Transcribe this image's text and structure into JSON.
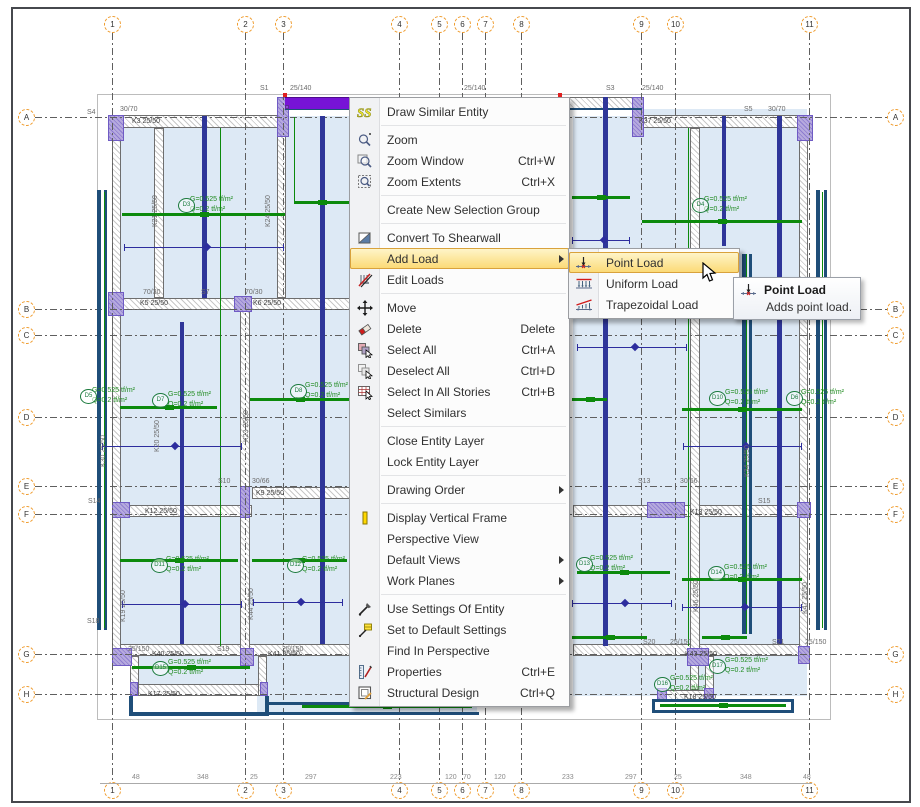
{
  "window": {
    "bg": "#ffffff",
    "accent_highlight": "#fbd973",
    "selection_color": "#7713d6"
  },
  "context_menu": {
    "x": 349,
    "y": 97,
    "w": 221,
    "items": [
      {
        "label": "Draw Similar Entity",
        "icon": "draw-similar-icon",
        "sep_after": true
      },
      {
        "label": "Zoom",
        "icon": "zoom-icon"
      },
      {
        "label": "Zoom Window",
        "icon": "zoom-window-icon",
        "shortcut": "Ctrl+W"
      },
      {
        "label": "Zoom Extents",
        "icon": "zoom-extents-icon",
        "shortcut": "Ctrl+X",
        "sep_after": true
      },
      {
        "label": "Create New Selection Group",
        "sep_after": true
      },
      {
        "label": "Convert To Shearwall",
        "icon": "shearwall-icon"
      },
      {
        "label": "Add Load",
        "submenu": true,
        "highlighted": true
      },
      {
        "label": "Edit Loads",
        "icon": "edit-loads-icon",
        "sep_after": true
      },
      {
        "label": "Move",
        "icon": "move-icon"
      },
      {
        "label": "Delete",
        "icon": "delete-icon",
        "shortcut": "Delete"
      },
      {
        "label": "Select All",
        "icon": "select-all-icon",
        "shortcut": "Ctrl+A"
      },
      {
        "label": "Deselect All",
        "icon": "deselect-all-icon",
        "shortcut": "Ctrl+D"
      },
      {
        "label": "Select In All Stories",
        "icon": "select-stories-icon",
        "shortcut": "Ctrl+B"
      },
      {
        "label": "Select Similars",
        "sep_after": true
      },
      {
        "label": "Close Entity Layer"
      },
      {
        "label": "Lock Entity Layer",
        "sep_after": true
      },
      {
        "label": "Drawing Order",
        "submenu": true,
        "sep_after": true
      },
      {
        "label": "Display Vertical Frame",
        "icon": "column-icon"
      },
      {
        "label": "Perspective View"
      },
      {
        "label": "Default Views",
        "submenu": true
      },
      {
        "label": "Work Planes",
        "submenu": true,
        "sep_after": true
      },
      {
        "label": "Use Settings Of Entity",
        "icon": "pipette-icon"
      },
      {
        "label": "Set to Default Settings",
        "icon": "pipette-default-icon"
      },
      {
        "label": "Find In Perspective"
      },
      {
        "label": "Properties",
        "icon": "properties-icon",
        "shortcut": "Ctrl+E"
      },
      {
        "label": "Structural Design",
        "icon": "structural-design-icon",
        "shortcut": "Ctrl+Q"
      }
    ]
  },
  "submenu": {
    "x": 568,
    "y": 248,
    "w": 172,
    "items": [
      {
        "label": "Point Load",
        "icon": "point-load-icon",
        "highlighted": true
      },
      {
        "label": "Uniform Load",
        "icon": "uniform-load-icon"
      },
      {
        "label": "Trapezoidal Load",
        "icon": "trapezoidal-load-icon"
      }
    ]
  },
  "tooltip": {
    "x": 733,
    "y": 277,
    "title": "Point Load",
    "body": "Adds point load.",
    "icon": "point-load-icon"
  },
  "plan": {
    "frame": [
      95,
      92,
      732,
      624
    ],
    "grid_numbers": [
      {
        "n": "1",
        "x": 110
      },
      {
        "n": "2",
        "x": 243
      },
      {
        "n": "3",
        "x": 281
      },
      {
        "n": "4",
        "x": 397
      },
      {
        "n": "5",
        "x": 437
      },
      {
        "n": "6",
        "x": 460
      },
      {
        "n": "7",
        "x": 483
      },
      {
        "n": "8",
        "x": 519
      },
      {
        "n": "9",
        "x": 639
      },
      {
        "n": "10",
        "x": 673
      },
      {
        "n": "11",
        "x": 807
      }
    ],
    "grid_letters": [
      {
        "n": "A",
        "y": 115
      },
      {
        "n": "B",
        "y": 307
      },
      {
        "n": "C",
        "y": 333
      },
      {
        "n": "D",
        "y": 415
      },
      {
        "n": "E",
        "y": 484
      },
      {
        "n": "F",
        "y": 512
      },
      {
        "n": "G",
        "y": 652
      },
      {
        "n": "H",
        "y": 692
      }
    ],
    "bottom_dims": [
      {
        "t": "48",
        "x": 130
      },
      {
        "t": "348",
        "x": 195
      },
      {
        "t": "25",
        "x": 248
      },
      {
        "t": "297",
        "x": 303
      },
      {
        "t": "223",
        "x": 388
      },
      {
        "t": "120",
        "x": 443
      },
      {
        "t": "70",
        "x": 461
      },
      {
        "t": "120",
        "x": 492
      },
      {
        "t": "233",
        "x": 560
      },
      {
        "t": "297",
        "x": 623
      },
      {
        "t": "25",
        "x": 672
      },
      {
        "t": "348",
        "x": 738
      },
      {
        "t": "48",
        "x": 801
      }
    ],
    "slabs": [
      [
        115,
        114,
        234,
        531
      ],
      [
        571,
        114,
        234,
        531
      ],
      [
        128,
        654,
        221,
        40
      ],
      [
        571,
        654,
        234,
        40
      ],
      [
        255,
        654,
        220,
        56
      ],
      [
        640,
        107,
        165,
        7
      ]
    ],
    "hatch_h": [
      [
        283,
        95,
        357,
        12
      ],
      [
        115,
        113,
        168,
        13
      ],
      [
        640,
        113,
        165,
        13
      ],
      [
        115,
        296,
        234,
        12
      ],
      [
        571,
        299,
        234,
        12
      ],
      [
        115,
        503,
        135,
        12
      ],
      [
        250,
        485,
        99,
        12
      ],
      [
        571,
        503,
        234,
        12
      ],
      [
        115,
        642,
        234,
        12
      ],
      [
        571,
        642,
        234,
        12
      ],
      [
        128,
        682,
        137,
        12
      ],
      [
        655,
        688,
        57,
        12
      ]
    ],
    "hatch_v": [
      [
        110,
        114,
        9,
        540
      ],
      [
        797,
        114,
        9,
        540
      ],
      [
        152,
        126,
        10,
        170
      ],
      [
        275,
        126,
        9,
        170
      ],
      [
        238,
        296,
        10,
        358
      ],
      [
        688,
        126,
        10,
        528
      ],
      [
        128,
        654,
        9,
        40
      ],
      [
        256,
        654,
        9,
        40
      ],
      [
        688,
        654,
        9,
        34
      ],
      [
        703,
        654,
        9,
        34
      ]
    ],
    "columns": [
      [
        106,
        113,
        16,
        26
      ],
      [
        275,
        95,
        12,
        40
      ],
      [
        630,
        95,
        12,
        40
      ],
      [
        795,
        113,
        16,
        26
      ],
      [
        106,
        290,
        16,
        24
      ],
      [
        232,
        294,
        18,
        16
      ],
      [
        795,
        290,
        16,
        20
      ],
      [
        713,
        295,
        16,
        16
      ],
      [
        110,
        500,
        18,
        16
      ],
      [
        238,
        484,
        10,
        32
      ],
      [
        645,
        500,
        38,
        16
      ],
      [
        795,
        500,
        14,
        16
      ],
      [
        110,
        646,
        20,
        18
      ],
      [
        238,
        646,
        14,
        18
      ],
      [
        685,
        646,
        22,
        18
      ],
      [
        796,
        644,
        12,
        18
      ],
      [
        128,
        680,
        8,
        14
      ],
      [
        258,
        680,
        8,
        14
      ],
      [
        655,
        686,
        10,
        14
      ],
      [
        702,
        686,
        10,
        14
      ]
    ],
    "navy_walls": [
      [
        95,
        188,
        4,
        440
      ],
      [
        102,
        188,
        3,
        440
      ],
      [
        814,
        188,
        4,
        440
      ],
      [
        822,
        188,
        3,
        440
      ],
      [
        740,
        252,
        4,
        380
      ],
      [
        747,
        252,
        3,
        380
      ],
      [
        127,
        694,
        4,
        20
      ],
      [
        263,
        694,
        4,
        20
      ],
      [
        127,
        710,
        140,
        4
      ],
      [
        265,
        700,
        212,
        3
      ],
      [
        265,
        710,
        212,
        3
      ],
      [
        650,
        697,
        3,
        14
      ],
      [
        789,
        697,
        3,
        14
      ],
      [
        650,
        697,
        142,
        3
      ],
      [
        650,
        708,
        142,
        3
      ],
      [
        283,
        106,
        357,
        2
      ]
    ],
    "navy_beams_v": [
      [
        200,
        114,
        5,
        182
      ],
      [
        178,
        320,
        4,
        322
      ],
      [
        318,
        114,
        5,
        528
      ],
      [
        601,
        95,
        5,
        549
      ],
      [
        720,
        114,
        4,
        130
      ],
      [
        775,
        114,
        5,
        528
      ]
    ],
    "green_h": [
      [
        120,
        211,
        163
      ],
      [
        292,
        199,
        55
      ],
      [
        570,
        194,
        58
      ],
      [
        640,
        218,
        160
      ],
      [
        118,
        404,
        97
      ],
      [
        248,
        396,
        99
      ],
      [
        570,
        396,
        35
      ],
      [
        680,
        406,
        120
      ],
      [
        118,
        557,
        118
      ],
      [
        250,
        557,
        95
      ],
      [
        575,
        569,
        93
      ],
      [
        680,
        576,
        120
      ],
      [
        130,
        664,
        118
      ],
      [
        570,
        634,
        75
      ],
      [
        700,
        634,
        45
      ],
      [
        300,
        703,
        170
      ],
      [
        658,
        702,
        126
      ]
    ],
    "green_v": [
      [
        218,
        126,
        518
      ],
      [
        292,
        115,
        84
      ],
      [
        686,
        126,
        518
      ],
      [
        102,
        190,
        436
      ],
      [
        820,
        190,
        436
      ],
      [
        744,
        252,
        380
      ]
    ],
    "dim_lines": [
      [
        122,
        245,
        160
      ],
      [
        570,
        238,
        58
      ],
      [
        100,
        444,
        140
      ],
      [
        681,
        444,
        119
      ],
      [
        120,
        602,
        120
      ],
      [
        251,
        600,
        90
      ],
      [
        570,
        601,
        100
      ],
      [
        680,
        605,
        120
      ],
      [
        575,
        345,
        110
      ]
    ],
    "sel_beam": [
      283,
      95,
      277,
      11
    ],
    "handles": {
      "red": [
        [
          281,
          91
        ],
        [
          556,
          91
        ]
      ],
      "grips": [
        [
          283,
          103
        ],
        [
          418,
          103
        ],
        [
          556,
          103
        ]
      ]
    },
    "labels": [
      {
        "t": "S1",
        "x": 258,
        "y": 83
      },
      {
        "t": "25/140",
        "x": 288,
        "y": 83
      },
      {
        "t": "25/140",
        "x": 462,
        "y": 83
      },
      {
        "t": "S3",
        "x": 604,
        "y": 83
      },
      {
        "t": "25/140",
        "x": 640,
        "y": 83
      },
      {
        "t": "S4",
        "x": 85,
        "y": 107
      },
      {
        "t": "30/70",
        "x": 118,
        "y": 104
      },
      {
        "t": "K3 25/50",
        "x": 130,
        "y": 116,
        "c": "k"
      },
      {
        "t": "S5",
        "x": 742,
        "y": 104
      },
      {
        "t": "30/70",
        "x": 766,
        "y": 104
      },
      {
        "t": "K37 25/50",
        "x": 637,
        "y": 116,
        "c": "k"
      },
      {
        "t": "70/30",
        "x": 141,
        "y": 287
      },
      {
        "t": "S7",
        "x": 199,
        "y": 287
      },
      {
        "t": "70/30",
        "x": 243,
        "y": 287
      },
      {
        "t": "K5 25/50",
        "x": 138,
        "y": 298,
        "c": "k"
      },
      {
        "t": "K6 25/50",
        "x": 251,
        "y": 298,
        "c": "k"
      },
      {
        "t": "S10",
        "x": 216,
        "y": 476
      },
      {
        "t": "30/66",
        "x": 250,
        "y": 476
      },
      {
        "t": "K9 25/50",
        "x": 254,
        "y": 488,
        "c": "k"
      },
      {
        "t": "S13",
        "x": 636,
        "y": 476
      },
      {
        "t": "30/66",
        "x": 678,
        "y": 476
      },
      {
        "t": "S15",
        "x": 756,
        "y": 496
      },
      {
        "t": "K13 25/50",
        "x": 688,
        "y": 507,
        "c": "k"
      },
      {
        "t": "K12 25/50",
        "x": 143,
        "y": 506,
        "c": "k"
      },
      {
        "t": "S14",
        "x": 86,
        "y": 496
      },
      {
        "t": "S18",
        "x": 85,
        "y": 616
      },
      {
        "t": "25/150",
        "x": 126,
        "y": 644
      },
      {
        "t": "S19",
        "x": 215,
        "y": 644
      },
      {
        "t": "25/150",
        "x": 280,
        "y": 644
      },
      {
        "t": "K40 25/50",
        "x": 150,
        "y": 649,
        "c": "k"
      },
      {
        "t": "K41 25/50",
        "x": 266,
        "y": 649,
        "c": "k"
      },
      {
        "t": "K17 25/50",
        "x": 146,
        "y": 689,
        "c": "k"
      },
      {
        "t": "S20",
        "x": 641,
        "y": 637
      },
      {
        "t": "25/150",
        "x": 668,
        "y": 637
      },
      {
        "t": "S21",
        "x": 770,
        "y": 637
      },
      {
        "t": "25/150",
        "x": 803,
        "y": 637
      },
      {
        "t": "K43 25/50",
        "x": 683,
        "y": 649,
        "c": "k"
      },
      {
        "t": "K18 25/50",
        "x": 682,
        "y": 692,
        "c": "k"
      },
      {
        "t": "K21 25/50",
        "x": 150,
        "y": 225,
        "r": 1
      },
      {
        "t": "K24 25/50",
        "x": 263,
        "y": 225,
        "r": 1
      },
      {
        "t": "K20 25/50",
        "x": 152,
        "y": 450,
        "r": 1
      },
      {
        "t": "K23 25/50",
        "x": 241,
        "y": 440,
        "r": 1
      },
      {
        "t": "K30 25/50",
        "x": 98,
        "y": 465,
        "r": 1
      },
      {
        "t": "K19 25/50",
        "x": 118,
        "y": 620,
        "r": 1
      },
      {
        "t": "K44 25/50",
        "x": 246,
        "y": 618,
        "r": 1
      },
      {
        "t": "K46 25/50",
        "x": 691,
        "y": 610,
        "r": 1
      },
      {
        "t": "K47 25/50",
        "x": 800,
        "y": 612,
        "r": 1
      },
      {
        "t": "K34 25/50",
        "x": 742,
        "y": 475,
        "r": 1
      }
    ],
    "green_texts": [
      {
        "t": "G=0.525 tf/m²",
        "x": 188,
        "y": 194
      },
      {
        "t": "Q=0.2 tf/m²",
        "x": 188,
        "y": 204
      },
      {
        "t": "G=0.525 tf/m²",
        "x": 702,
        "y": 194
      },
      {
        "t": "Q=0.2 tf/m²",
        "x": 702,
        "y": 204
      },
      {
        "t": "G=0.525 tf/m²",
        "x": 90,
        "y": 385
      },
      {
        "t": "Q=0.2 tf/m²",
        "x": 90,
        "y": 395
      },
      {
        "t": "G=0.525 tf/m²",
        "x": 166,
        "y": 389
      },
      {
        "t": "Q=0.2 tf/m²",
        "x": 166,
        "y": 399
      },
      {
        "t": "G=0.525 tf/m²",
        "x": 303,
        "y": 380
      },
      {
        "t": "Q=0.2 tf/m²",
        "x": 303,
        "y": 390
      },
      {
        "t": "G=0.525 tf/m²",
        "x": 723,
        "y": 387
      },
      {
        "t": "Q=0.2 tf/m²",
        "x": 723,
        "y": 397
      },
      {
        "t": "G=0.525 tf/m²",
        "x": 799,
        "y": 387
      },
      {
        "t": "Q=0.2 tf/m²",
        "x": 799,
        "y": 397
      },
      {
        "t": "G=0.525 tf/m²",
        "x": 164,
        "y": 554
      },
      {
        "t": "Q=0.2 tf/m²",
        "x": 164,
        "y": 564
      },
      {
        "t": "G=0.525 tf/m²",
        "x": 300,
        "y": 554
      },
      {
        "t": "Q=0.2 tf/m²",
        "x": 300,
        "y": 564
      },
      {
        "t": "G=0.525 tf/m²",
        "x": 588,
        "y": 553
      },
      {
        "t": "Q=0.2 tf/m²",
        "x": 588,
        "y": 563
      },
      {
        "t": "G=0.525 tf/m²",
        "x": 722,
        "y": 562
      },
      {
        "t": "Q=0.2 tf/m²",
        "x": 722,
        "y": 572
      },
      {
        "t": "G=0.525 tf/m²",
        "x": 166,
        "y": 657
      },
      {
        "t": "Q=0.2 tf/m²",
        "x": 166,
        "y": 667
      },
      {
        "t": "G=0.525 tf/m²",
        "x": 668,
        "y": 673
      },
      {
        "t": "Q=0.2 tf/m²",
        "x": 668,
        "y": 683
      },
      {
        "t": "G=0.525 tf/m²",
        "x": 723,
        "y": 655
      },
      {
        "t": "Q=0.2 tf/m²",
        "x": 723,
        "y": 665
      }
    ],
    "slab_circles": [
      {
        "t": "D3",
        "x": 176,
        "y": 196
      },
      {
        "t": "D4",
        "x": 690,
        "y": 196
      },
      {
        "t": "D5",
        "x": 78,
        "y": 387
      },
      {
        "t": "D7",
        "x": 150,
        "y": 391
      },
      {
        "t": "D8",
        "x": 288,
        "y": 382
      },
      {
        "t": "D10",
        "x": 707,
        "y": 389
      },
      {
        "t": "D6",
        "x": 784,
        "y": 389
      },
      {
        "t": "D11",
        "x": 149,
        "y": 556
      },
      {
        "t": "D12",
        "x": 285,
        "y": 556
      },
      {
        "t": "D13",
        "x": 574,
        "y": 555
      },
      {
        "t": "D14",
        "x": 706,
        "y": 564
      },
      {
        "t": "D15",
        "x": 150,
        "y": 659
      },
      {
        "t": "D16",
        "x": 652,
        "y": 675
      },
      {
        "t": "D17",
        "x": 707,
        "y": 657
      }
    ]
  }
}
